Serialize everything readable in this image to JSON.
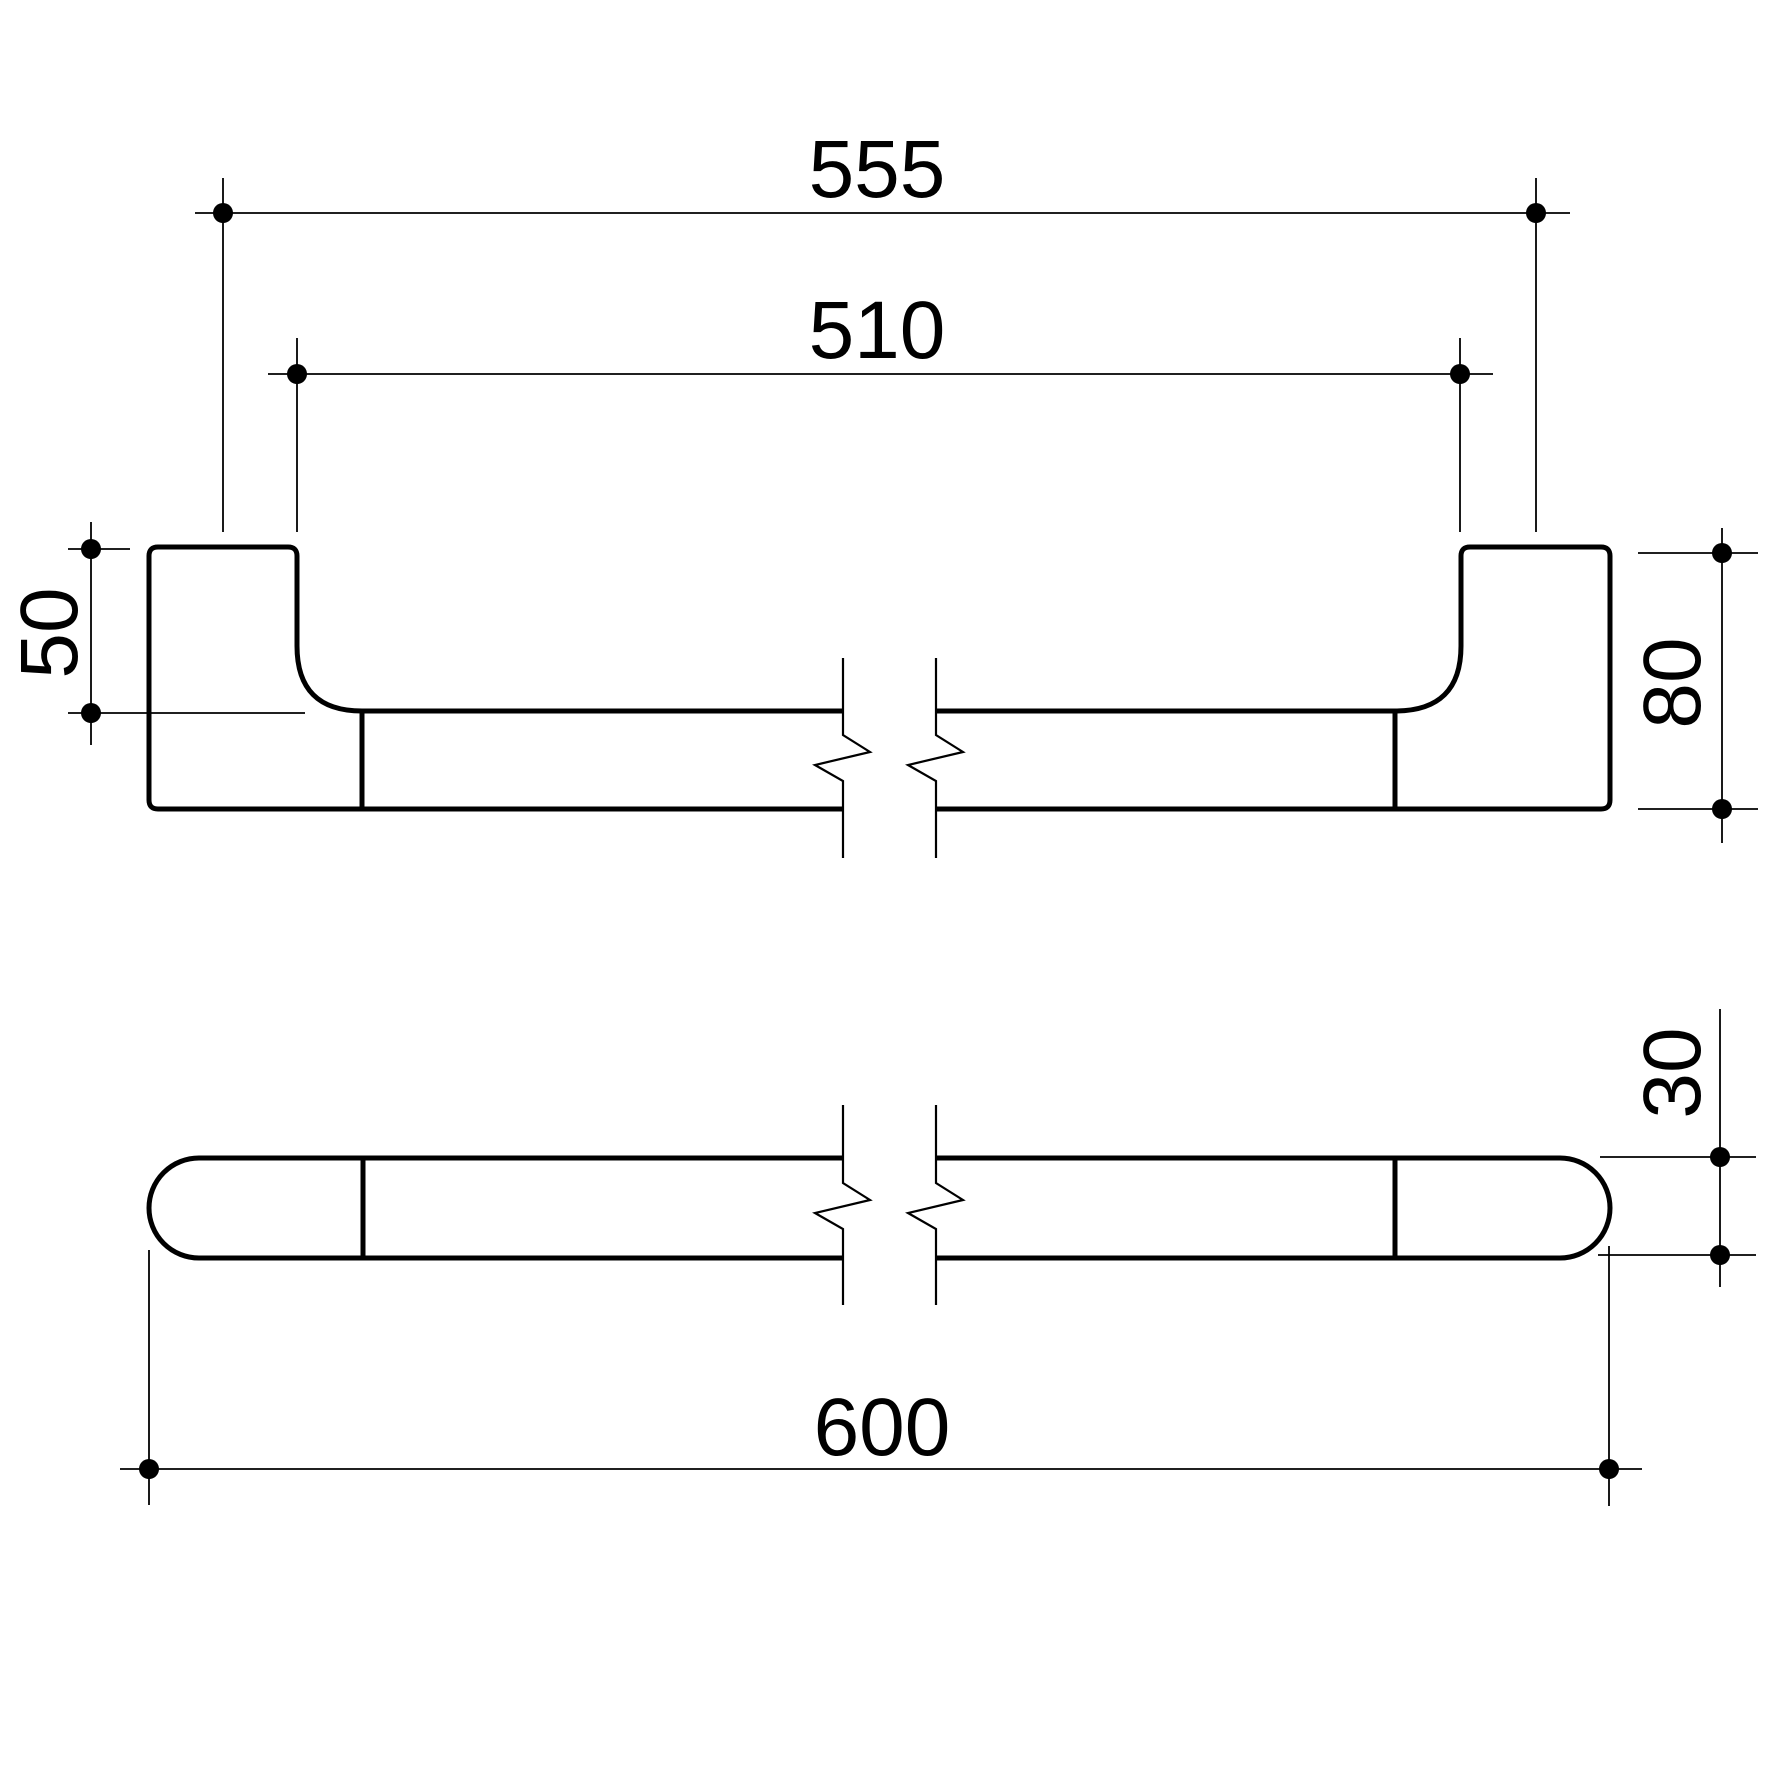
{
  "page": {
    "background_color": "#ffffff",
    "line_color": "#000000"
  },
  "drawing": {
    "type": "technical-dimension-drawing",
    "subject": "towel rail / grab bar with two wall brackets, shown with break lines",
    "views": [
      {
        "name": "front-elevation",
        "description": "bar with two end brackets, filleted transitions, broken centre"
      },
      {
        "name": "plan-view",
        "description": "stadium (capsule) profile with bracket joint lines, broken centre"
      }
    ],
    "dimensions": {
      "fixing_centres": "555",
      "inner_span": "510",
      "bracket_top_to_rail": "50",
      "bracket_height": "80",
      "rail_thickness": "30",
      "overall_length": "600"
    }
  }
}
